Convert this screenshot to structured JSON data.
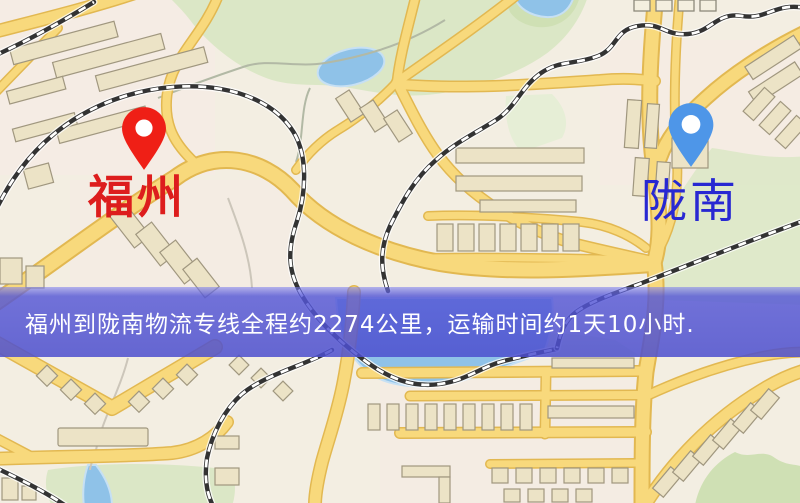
{
  "map": {
    "origin": {
      "name": "福州",
      "marker_color": "#ef1f16",
      "label_color": "#dd1d1d"
    },
    "destination": {
      "name": "陇南",
      "marker_color": "#4e96e8",
      "label_color": "#2828d2"
    },
    "banner": {
      "text": "福州到陇南物流专线全程约2274公里，运输时间约1天10小时.",
      "background": "#5052d0",
      "text_color": "#ffffff"
    },
    "legend": {
      "road_color": "#f8d97c",
      "park_color": "#dbe7c6",
      "water_color": "#8fc2e8",
      "railway_color": "#333333",
      "background_color": "#f3eee2"
    }
  }
}
